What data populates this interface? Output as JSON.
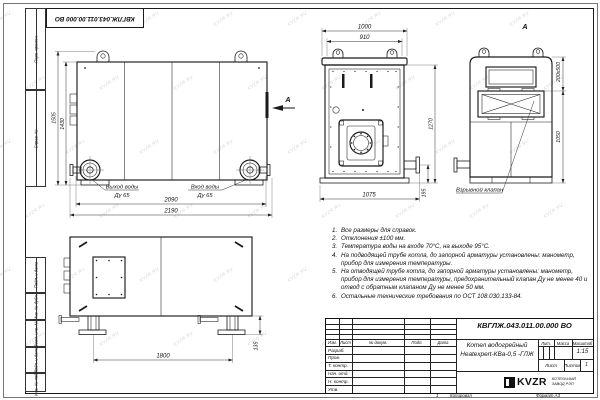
{
  "frame": {
    "watermark": "KVZR.RU",
    "doc_number_top": "КВГЛЖ.043.011.00.000 ВО",
    "sidebar": [
      "Перв. примен.",
      "Справ. №",
      "Подп. и дата",
      "Инв. № дубл.",
      "Взам. инв. №",
      "Подп. и дата",
      "Инв. № подл."
    ]
  },
  "views": {
    "side": {
      "dim_height_outer": "1505",
      "dim_height_inner": "1430",
      "dim_width_inner": "2090",
      "dim_width_outer": "2190",
      "outlet_label": "Выход воды",
      "outlet_size": "Ду 65",
      "inlet_label": "Вход воды",
      "inlet_size": "Ду 65",
      "arrow_label": "А"
    },
    "front": {
      "dim_top": "1000",
      "dim_top_inner": "910",
      "dim_height": "1270",
      "dim_pipe": "195",
      "dim_bottom": "1075"
    },
    "view_a": {
      "title": "А",
      "dim_valve": "200x500",
      "dim_height": "1050",
      "valve_label": "Взрывной клапан"
    },
    "rear": {
      "dim_feet": "1800",
      "dim_foot": "135"
    }
  },
  "notes": {
    "items": [
      {
        "n": "1.",
        "t": "Все размеры для справок."
      },
      {
        "n": "2.",
        "t": "Отклонения ±100 мм."
      },
      {
        "n": "3.",
        "t": "Температура воды на входе 70°С, на выходе 95°С."
      },
      {
        "n": "4.",
        "t": "На подводящей трубе котла, до запорной арматуры установлены: манометр, прибор для измерения температуры."
      },
      {
        "n": "5.",
        "t": "На отводящей трубе котла, до запорной арматуры установлены: манометр, прибор для измерения температуры, предохранительный клапан Ду не менее 40 и отвод с обратным клапаном Ду не менее 50 мм."
      },
      {
        "n": "6.",
        "t": "Остальные технические требования по ОСТ 108.030.133-84."
      }
    ]
  },
  "title_block": {
    "doc_number": "КВГЛЖ.043.011.00.000 ВО",
    "product_name_1": "Котел водогрейный",
    "product_name_2": "Heatexpert-КВа-0,5 -ГЛЖ",
    "col_headers": [
      "Изм.",
      "Лист",
      "№ докум.",
      "Подп.",
      "Дата"
    ],
    "row_labels": [
      "Разраб.",
      "Пров.",
      "Т. контр.",
      "Нач. отд.",
      "Н. контр.",
      "Утв."
    ],
    "lit_label": "Лит.",
    "mass_label": "Масса",
    "scale_label": "Масштаб",
    "scale_value": "1:15",
    "sheet_label": "Лист",
    "sheets_label": "Листов",
    "sheets_value": "1",
    "logo_text": "KVZR",
    "logo_caption_1": "КОТЕЛЬНЫЙ",
    "logo_caption_2": "ЗАВОД РЭП",
    "footer_page": "1",
    "footer_copied": "Копировал",
    "footer_format": "Формат А3"
  }
}
